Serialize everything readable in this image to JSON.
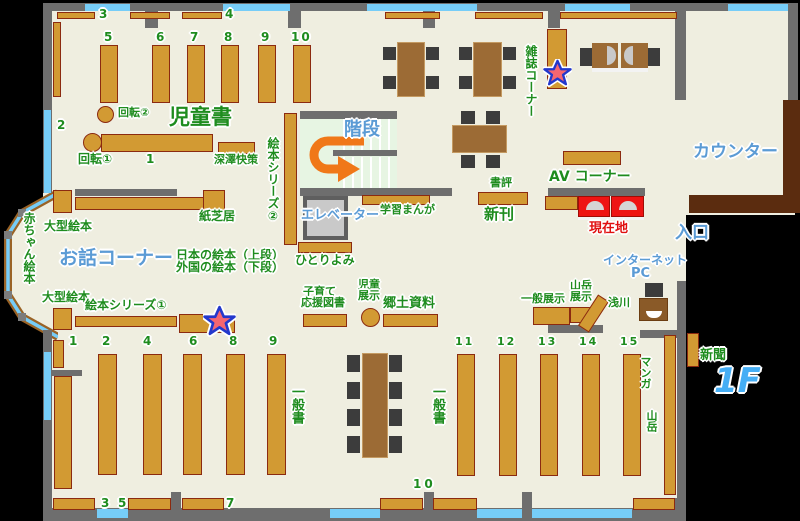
{
  "floor_label": "1F",
  "labels": {
    "jidosho": "児童書",
    "kaiten1": "回転①",
    "kaiten2": "回転②",
    "fukazawa": "深澤快策",
    "ehon_series1": "絵本シリーズ①",
    "ehon_series2": "絵本シリーズ②",
    "kamishibai": "紙芝居",
    "ogata_ehon_1": "大型絵本",
    "ogata_ehon_2": "大型絵本",
    "akachan_ehon": "赤ちゃん絵本",
    "ohanashi_corner": "お話コーナー",
    "nihon_no_ehon": "日本の絵本（上段）",
    "gaikoku_no_ehon": "外国の絵本（下段）",
    "kaidan": "階段",
    "elevator": "エレベーター",
    "gakushu_manga": "学習まんが",
    "hitoriyomi": "ひとりよみ",
    "zasshi_corner": "雑誌コーナー",
    "shohyo": "書評",
    "shinkan": "新刊",
    "av_corner": "AV コーナー",
    "genzaichi": "現在地",
    "counter": "カウンター",
    "iriguchi": "入口",
    "internet": "インターネット",
    "pc": "PC",
    "kosodate_1": "子育て",
    "kosodate_2": "応援図書",
    "jido_tenji_1": "児童",
    "jido_tenji_2": "展示",
    "kyodo_shiryo": "郷土資料",
    "ippan_tenji": "一般展示",
    "sangaku_tenji_1": "山岳",
    "sangaku_tenji_2": "展示",
    "asakawa": "浅川",
    "ippansho_left": "一般書",
    "ippansho_right": "一般書",
    "manga": "マンガ",
    "sangaku": "山岳",
    "shinbun": "新聞"
  },
  "numbers": {
    "t3": "3",
    "t4": "4",
    "c5": "5",
    "c6": "6",
    "c7": "7",
    "c8": "8",
    "c9": "9",
    "c10": "10",
    "c2": "2",
    "c1": "1",
    "bl1": "1",
    "bl2": "2",
    "bl4": "4",
    "bl6": "6",
    "bl8": "8",
    "bl9": "9",
    "bb3": "3",
    "bb5": "5",
    "bb7": "7",
    "bb10": "10",
    "br11": "11",
    "br12": "12",
    "br13": "13",
    "br14": "14",
    "br15": "15"
  },
  "colors": {
    "shelf": "#d29a33",
    "shelf_border": "#8b2a10",
    "wall": "#6e6e6e",
    "window": "#76cdf8",
    "floor": "#efeee0",
    "counter_desk": "#5b2c0f",
    "label_green": "#1e8c1e",
    "label_blue": "#5b9bd5",
    "highlight_red": "#ee1414",
    "arrow_orange": "#f07818"
  }
}
